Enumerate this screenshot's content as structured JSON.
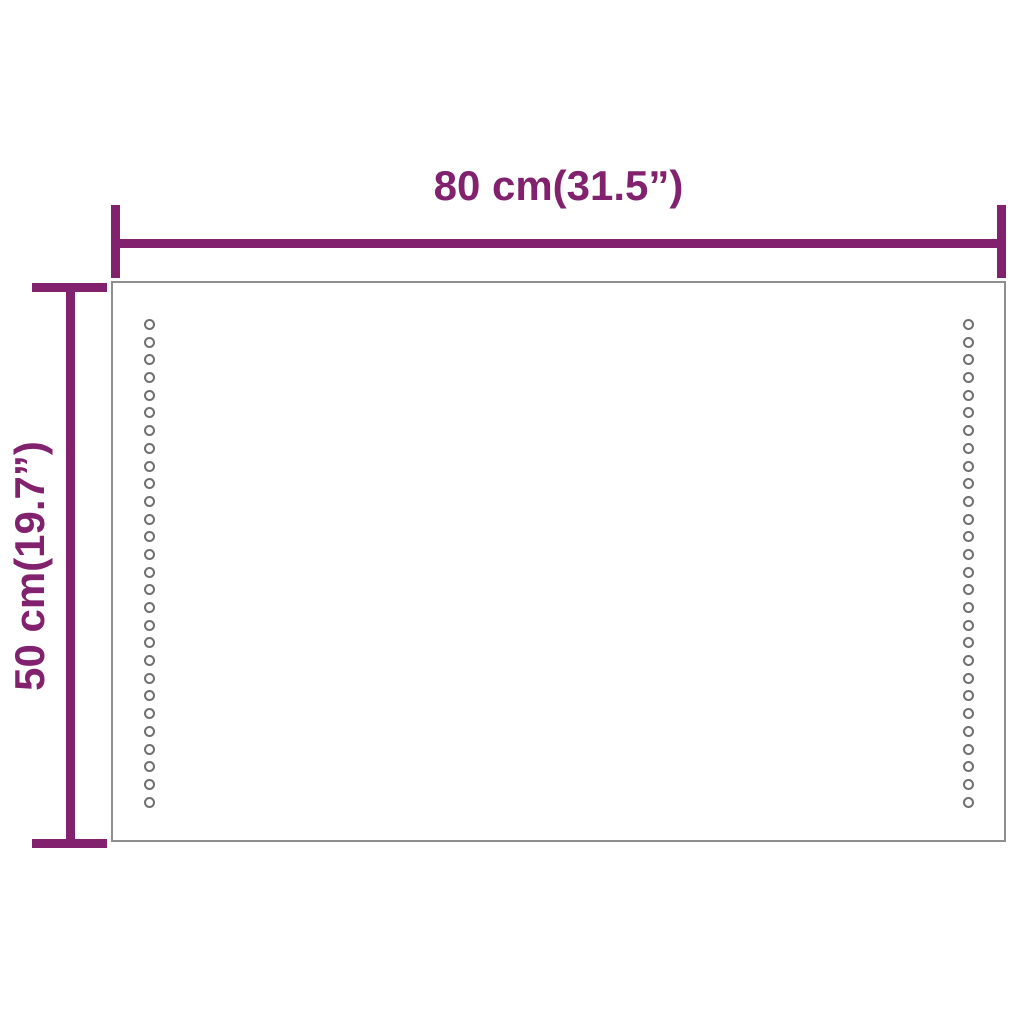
{
  "diagram": {
    "accent_color": "#82216E",
    "outline_color": "#8E8E8E",
    "dot_color": "#6F6F6F",
    "width_dimension": {
      "label": "80 cm(31.5”)"
    },
    "height_dimension": {
      "label": "50 cm(19.7”)"
    },
    "led": {
      "columns": 2,
      "dots_per_column": 28
    }
  }
}
